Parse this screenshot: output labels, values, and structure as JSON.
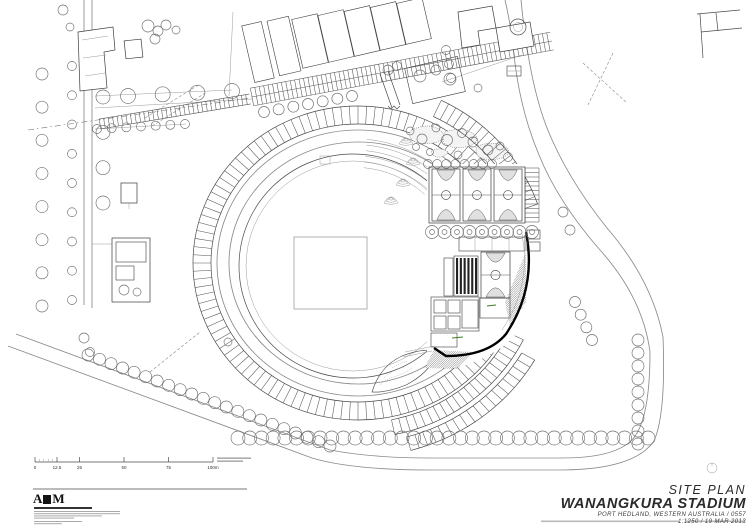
{
  "document": {
    "type": "architectural site plan drawing",
    "paper_color": "#ffffff",
    "ink_color": "#3c3c3c",
    "accent_green": "#4a7c2f"
  },
  "title_block": {
    "drawing_title": "SITE PLAN",
    "project_name": "WANANGKURA STADIUM",
    "location_line": "PORT HEDLAND, WESTERN AUSTRALIA / 0557",
    "scale_date_line": "1:1250 / 19 MAR 2013"
  },
  "logo": {
    "letter_a": "A",
    "letter_m": "M"
  },
  "scale_bar": {
    "labels": [
      "0",
      "12.5",
      "25",
      "50",
      "75",
      "100m"
    ]
  }
}
